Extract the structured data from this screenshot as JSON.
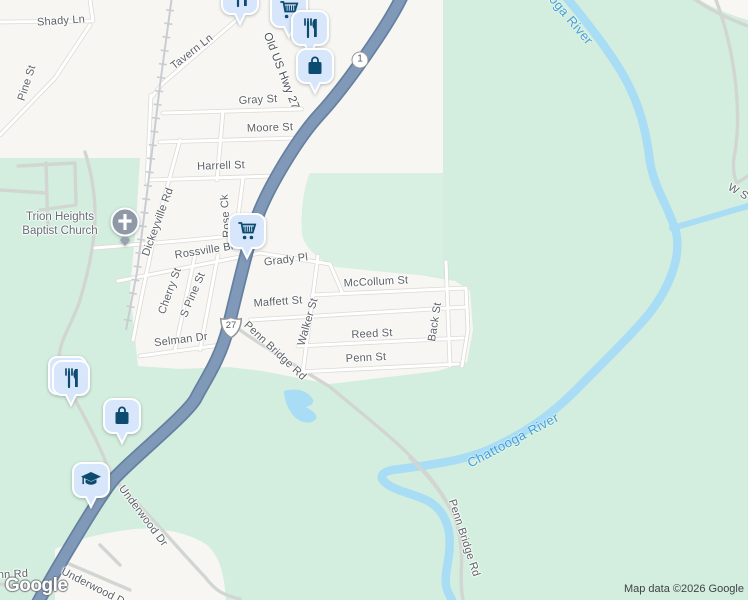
{
  "map": {
    "attribution": "Map data ©2026 Google",
    "logo_text": "Google",
    "church": {
      "line1": "Trion Heights",
      "line2": "Baptist Church"
    },
    "colors": {
      "land_urban": "#f7f6f2",
      "land_green": "#d3eede",
      "water": "#a9dcf5",
      "highway": "#8099b8",
      "pin_bg": "#d7e6fb",
      "pin_glyph": "#0d4a70",
      "road_label": "#5b6167",
      "water_label": "#42a0d6"
    },
    "shields": [
      {
        "route": "1",
        "style": "circle",
        "x": 360,
        "y": 60
      },
      {
        "route": "27",
        "style": "us",
        "x": 231,
        "y": 328
      }
    ],
    "labels": [
      {
        "t": "Shady Ln",
        "x": 61,
        "y": 21,
        "r": -4
      },
      {
        "t": "Pine St",
        "x": 27,
        "y": 83,
        "r": -72
      },
      {
        "t": "Tavern Ln",
        "x": 192,
        "y": 52,
        "r": -38
      },
      {
        "t": "Old US Hwy 27",
        "x": 281,
        "y": 71,
        "r": 69,
        "k": "h"
      },
      {
        "t": "Gray St",
        "x": 258,
        "y": 100,
        "r": -3
      },
      {
        "t": "Moore St",
        "x": 270,
        "y": 128,
        "r": -2
      },
      {
        "t": "Harrell St",
        "x": 221,
        "y": 166,
        "r": -2
      },
      {
        "t": "Dickeyville Rd",
        "x": 158,
        "y": 222,
        "r": -70
      },
      {
        "t": "Rose Ck",
        "x": 226,
        "y": 216,
        "r": -94
      },
      {
        "t": "Rossville Blvd",
        "x": 210,
        "y": 250,
        "r": -9
      },
      {
        "t": "Grady Pl",
        "x": 286,
        "y": 260,
        "r": -7
      },
      {
        "t": "McCollum St",
        "x": 376,
        "y": 282,
        "r": -3
      },
      {
        "t": "Cherry St",
        "x": 170,
        "y": 291,
        "r": -70
      },
      {
        "t": "S Pine St",
        "x": 193,
        "y": 295,
        "r": -67
      },
      {
        "t": "Maffett St",
        "x": 278,
        "y": 302,
        "r": -4
      },
      {
        "t": "Walker St",
        "x": 308,
        "y": 322,
        "r": -74
      },
      {
        "t": "Reed St",
        "x": 372,
        "y": 334,
        "r": -3
      },
      {
        "t": "Back St",
        "x": 435,
        "y": 322,
        "r": -81
      },
      {
        "t": "Penn St",
        "x": 366,
        "y": 358,
        "r": -3
      },
      {
        "t": "Selman Dr",
        "x": 181,
        "y": 340,
        "r": -7
      },
      {
        "t": "Penn Bridge Rd",
        "x": 275,
        "y": 351,
        "r": 43
      },
      {
        "t": "Penn Bridge Rd",
        "x": 464,
        "y": 538,
        "r": 72
      },
      {
        "t": "Underwood Dr",
        "x": 143,
        "y": 516,
        "r": 53
      },
      {
        "t": "Underwood Dairy Rd",
        "x": 62,
        "y": 565,
        "r": 27,
        "k": "a"
      },
      {
        "t": "Penn Rd",
        "x": -16,
        "y": 570,
        "r": -3,
        "k": "a"
      },
      {
        "t": "W S",
        "x": 738,
        "y": 192,
        "r": 30
      },
      {
        "t": "Chattooga River",
        "x": 558,
        "y": 4,
        "r": 50,
        "k": "w"
      },
      {
        "t": "Chattooga River",
        "x": 513,
        "y": 440,
        "r": -28,
        "k": "w"
      }
    ],
    "pins": [
      {
        "icon": "restaurant-icon",
        "x": 218,
        "y": -22
      },
      {
        "icon": "cart-icon",
        "x": 267,
        "y": -9
      },
      {
        "icon": "restaurant-icon",
        "x": 288,
        "y": 9
      },
      {
        "icon": "bag-icon",
        "x": 293,
        "y": 47
      },
      {
        "icon": "cart-icon",
        "x": 225,
        "y": 212
      },
      {
        "icon": "restaurant-icon",
        "x": 49,
        "y": 359,
        "double": true
      },
      {
        "icon": "bag-icon",
        "x": 100,
        "y": 397
      },
      {
        "icon": "school-icon",
        "x": 69,
        "y": 461
      }
    ]
  }
}
